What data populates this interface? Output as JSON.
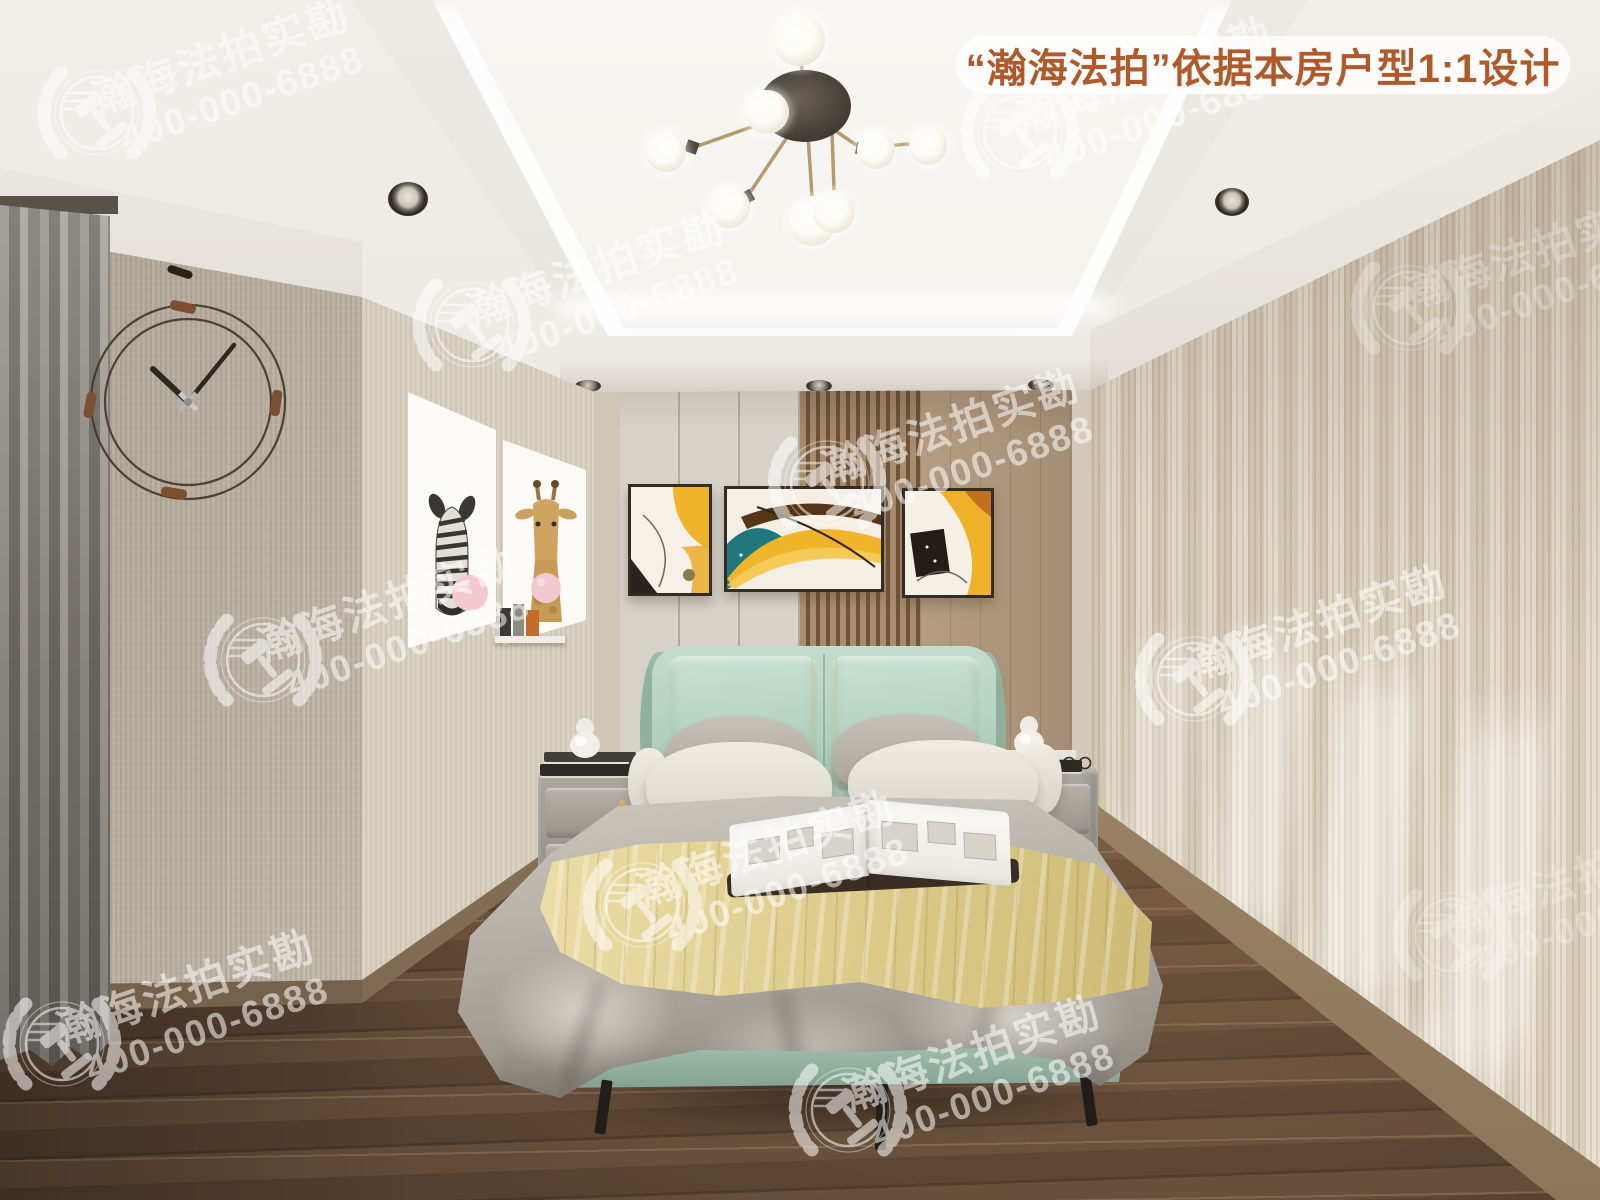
{
  "banner": {
    "text": "“瀚海法拍”依据本房户型1:1设计",
    "text_color": "#b05a2b",
    "bg_color": "rgba(255,255,255,0.82)"
  },
  "watermark": {
    "brand": "瀚海法拍实勘",
    "phone": "400-000-6888",
    "logo": "laurel-gavel-emblem",
    "color": "#ffffff"
  },
  "palette": {
    "ceiling": "#f2efe9",
    "left_wall": "#c6bdae",
    "accent_wall": "#d9d2c3",
    "back_wall_panel": "#d7d3cb",
    "wood_slats": "#8a6f52",
    "right_wall": "#d6cdb9",
    "floor_wood": "#5b4433",
    "curtain_gray": "#807c76",
    "headboard_mint": "#b7d2c2",
    "duvet_gray": "#b1aca4",
    "throw_yellow": "#e2d193",
    "painting_yellow": "#f0b42a",
    "painting_teal": "#20777e",
    "nightstand_gray": "#a19c94",
    "banner_orange": "#b05a2b"
  }
}
